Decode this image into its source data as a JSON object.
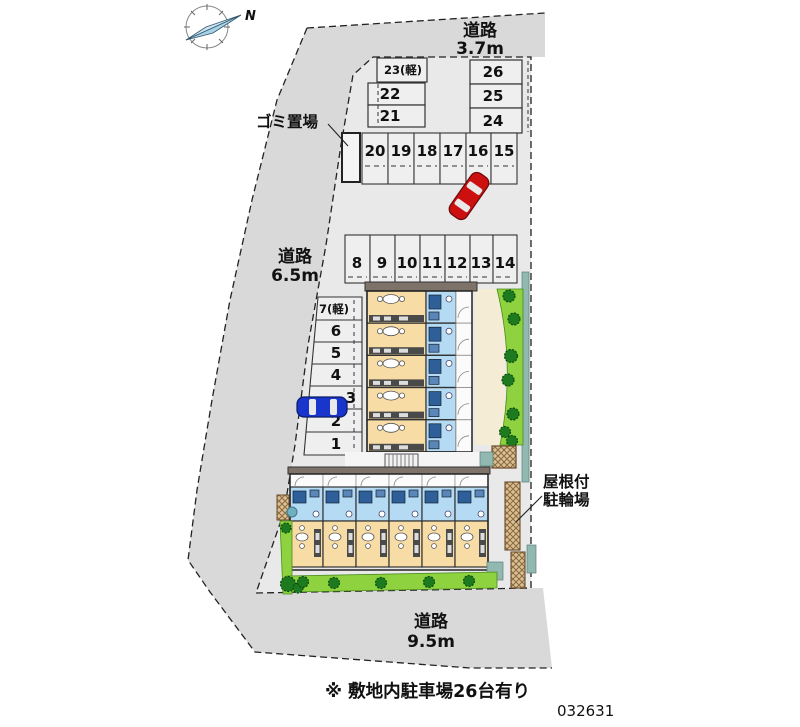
{
  "compass": {
    "north": "N"
  },
  "roads": {
    "top": {
      "label": "道路",
      "width": "3.7m"
    },
    "left": {
      "label": "道路",
      "width": "6.5m"
    },
    "bottom": {
      "label": "道路",
      "width": "9.5m"
    }
  },
  "facilities": {
    "garbage": "ゴミ置場",
    "bicycle_line1": "屋根付",
    "bicycle_line2": "駐輪場"
  },
  "parking": {
    "top_left_stack": [
      "23(軽)",
      "22",
      "21"
    ],
    "top_right_stack": [
      "26",
      "25",
      "24"
    ],
    "upper_row": [
      "20",
      "19",
      "18",
      "17",
      "16",
      "15"
    ],
    "middle_row": [
      "8",
      "9",
      "10",
      "11",
      "12",
      "13",
      "14"
    ],
    "left_column": [
      "7(軽)",
      "6",
      "5",
      "4",
      "3",
      "2",
      "1"
    ]
  },
  "note": "※ 敷地内駐車場26台有り",
  "plan_number": "032631",
  "colors": {
    "road": "#d9d9d9",
    "site": "#e9e9e9",
    "stall": "#efefef",
    "building_room_tan": "#f7dca6",
    "building_bath_blue": "#b5daf3",
    "fixture_blue": "#2f5f98",
    "roof_band": "#7d7369",
    "green_strip": "#8ed23f",
    "tree_green": "#1e7a1e",
    "walk_cream": "#f5ecd6",
    "wall_teal": "#92b8b2",
    "hatch_tan": "#d9c098",
    "car_red": "#cc1010",
    "car_blue": "#1a35cc"
  }
}
